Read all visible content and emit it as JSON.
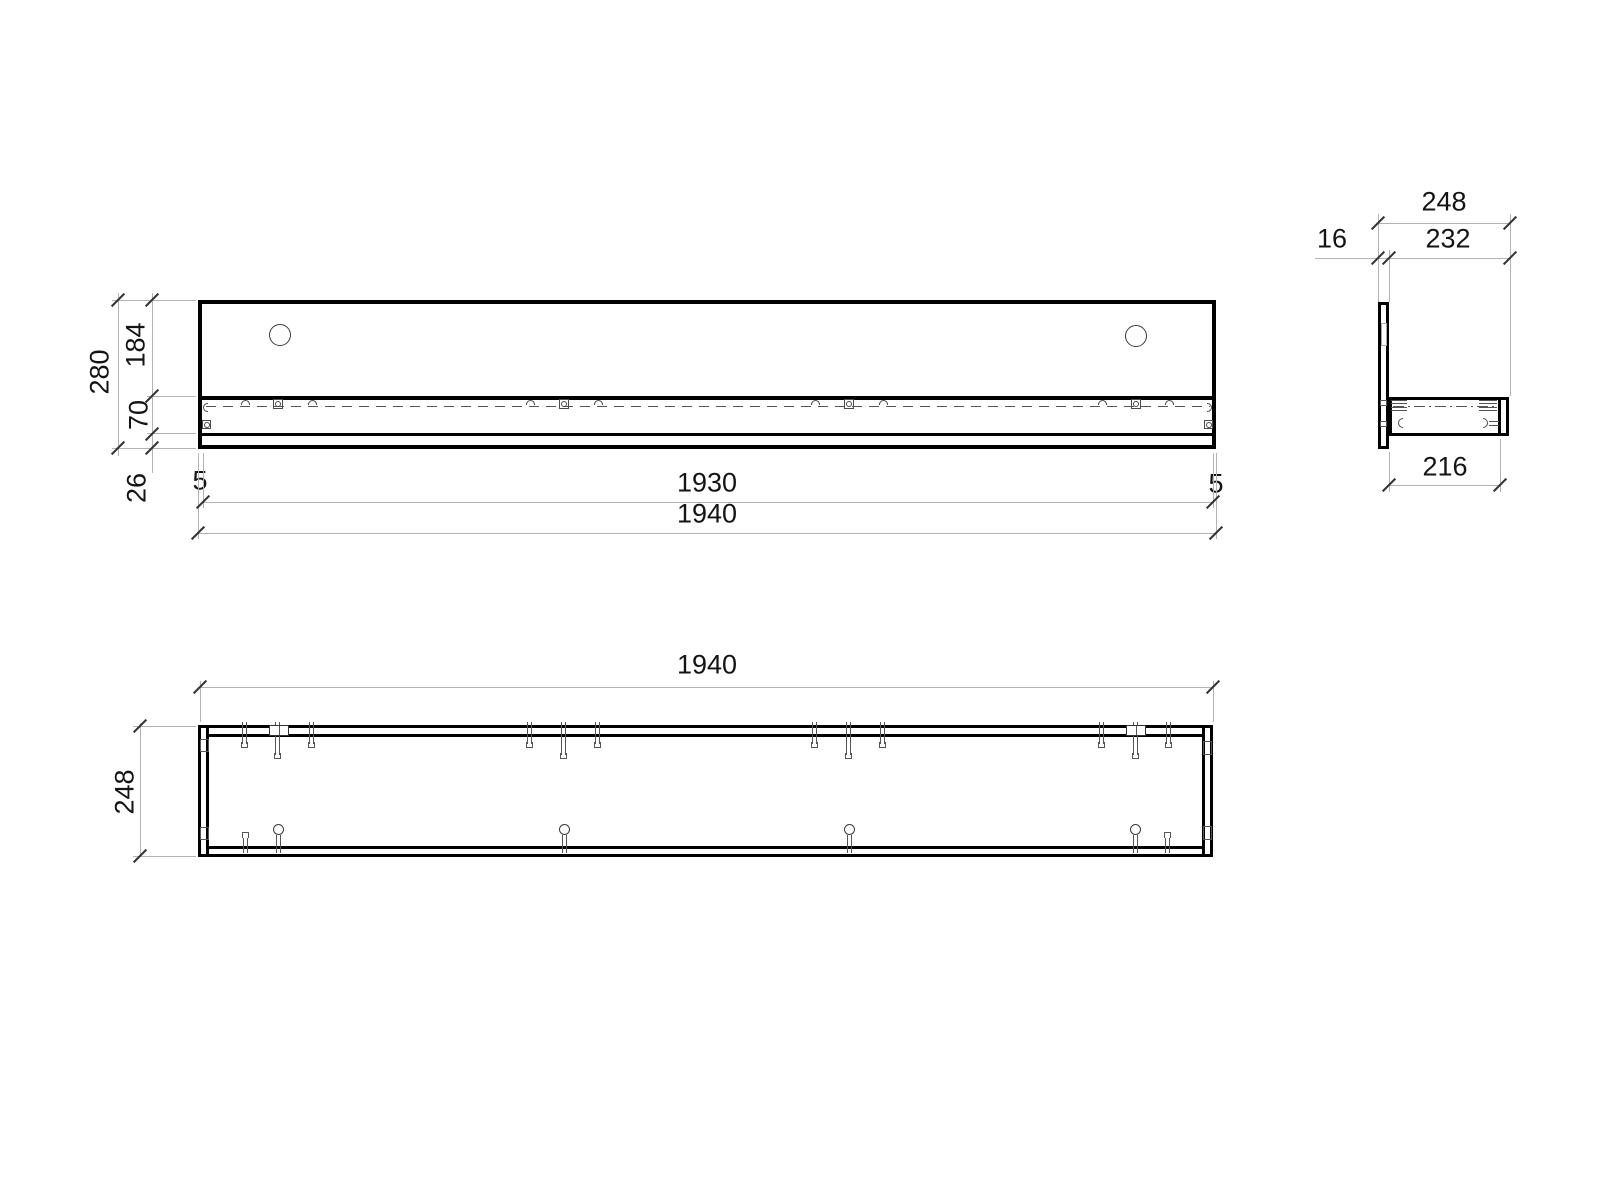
{
  "drawing": {
    "type": "technical-orthographic-drawing",
    "subject": "wall shelf / hanging board with back panel",
    "background_color": "#ffffff",
    "outline_color": "#000000",
    "dimension_line_color": "#b3b3b3",
    "text_color": "#141414"
  },
  "front_view": {
    "dims": {
      "overall_height": "280",
      "upper_panel": "184",
      "shelf_front": "70",
      "below_shelf": "26",
      "edge_left": "5",
      "edge_right": "5",
      "inner_length": "1930",
      "overall_length": "1940"
    }
  },
  "side_view": {
    "dims": {
      "overall_depth": "248",
      "shelf_zone": "232",
      "back_panel_thickness": "16",
      "shelf_depth": "216"
    }
  },
  "plan_view": {
    "dims": {
      "overall_length": "1940",
      "overall_depth": "248"
    }
  },
  "symbols": {
    "dowel_pin": "dowel-pin-icon",
    "cam_lock": "cam-lock-icon",
    "keyhole_hanger": "keyhole-icon",
    "mount_plate": "mount-plate-icon"
  }
}
